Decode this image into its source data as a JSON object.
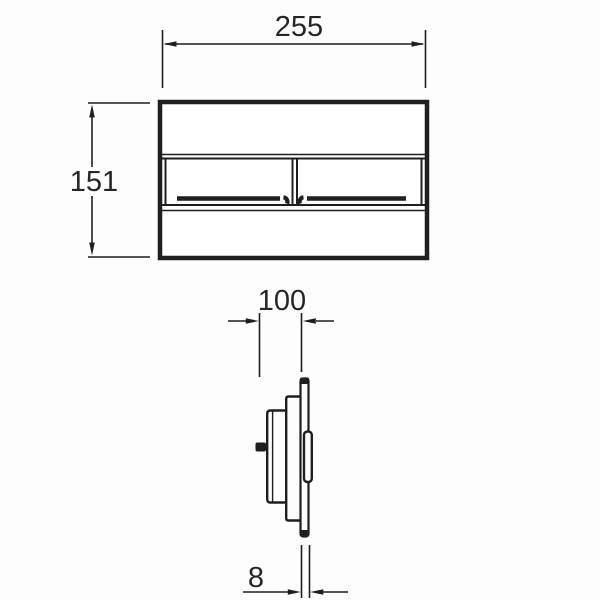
{
  "drawing": {
    "type": "technical-dimension-drawing",
    "dimensions": {
      "front_width": "255",
      "front_height": "151",
      "side_depth": "100",
      "plate_thickness": "8"
    },
    "colors": {
      "line": "#1f1f1f",
      "text": "#262626",
      "background": "#fdfdfd",
      "fill": "#ffffff"
    }
  }
}
